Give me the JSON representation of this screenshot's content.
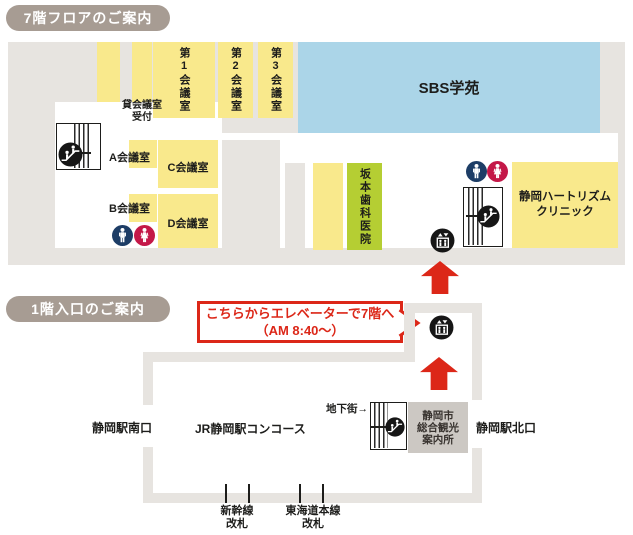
{
  "colors": {
    "badge_bg": "#a79c93",
    "floor_gray": "#e7e4e0",
    "room_yellow": "#f9e98c",
    "lime_green": "#b5ce33",
    "sbs_blue": "#abd5e8",
    "men_navy": "#1d3d66",
    "women_crimson": "#c41848",
    "accent_red": "#dc2718",
    "info_gray": "#ccc8c3",
    "ink": "#1d1d1b"
  },
  "floor7": {
    "badge": "7階フロアのご案内",
    "meeting1": "第1会議室",
    "meeting2": "第2会議室",
    "meeting3": "第3会議室",
    "sbs": "SBS学苑",
    "rental_l1": "貸会議室",
    "rental_l2": "受付",
    "roomA": "A会議室",
    "roomB": "B会議室",
    "roomC": "C会議室",
    "roomD": "D会議室",
    "sakamoto": "坂本歯科医院",
    "heart_l1": "静岡ハートリズム",
    "heart_l2": "クリニック"
  },
  "floor1": {
    "badge": "1階入口のご案内",
    "callout_l1": "こちらからエレベーターで7階へ",
    "callout_l2": "（AM 8:40〜）",
    "south_exit": "静岡駅南口",
    "concourse": "JR静岡駅コンコース",
    "underground": "地下街→",
    "info_l1": "静岡市",
    "info_l2": "総合観光",
    "info_l3": "案内所",
    "north_exit": "静岡駅北口",
    "shinkansen_l1": "新幹線",
    "shinkansen_l2": "改札",
    "tokaido_l1": "東海道本線",
    "tokaido_l2": "改札"
  },
  "icons": [
    "escalator",
    "elevator",
    "restroom-men",
    "restroom-women",
    "arrow-up"
  ]
}
